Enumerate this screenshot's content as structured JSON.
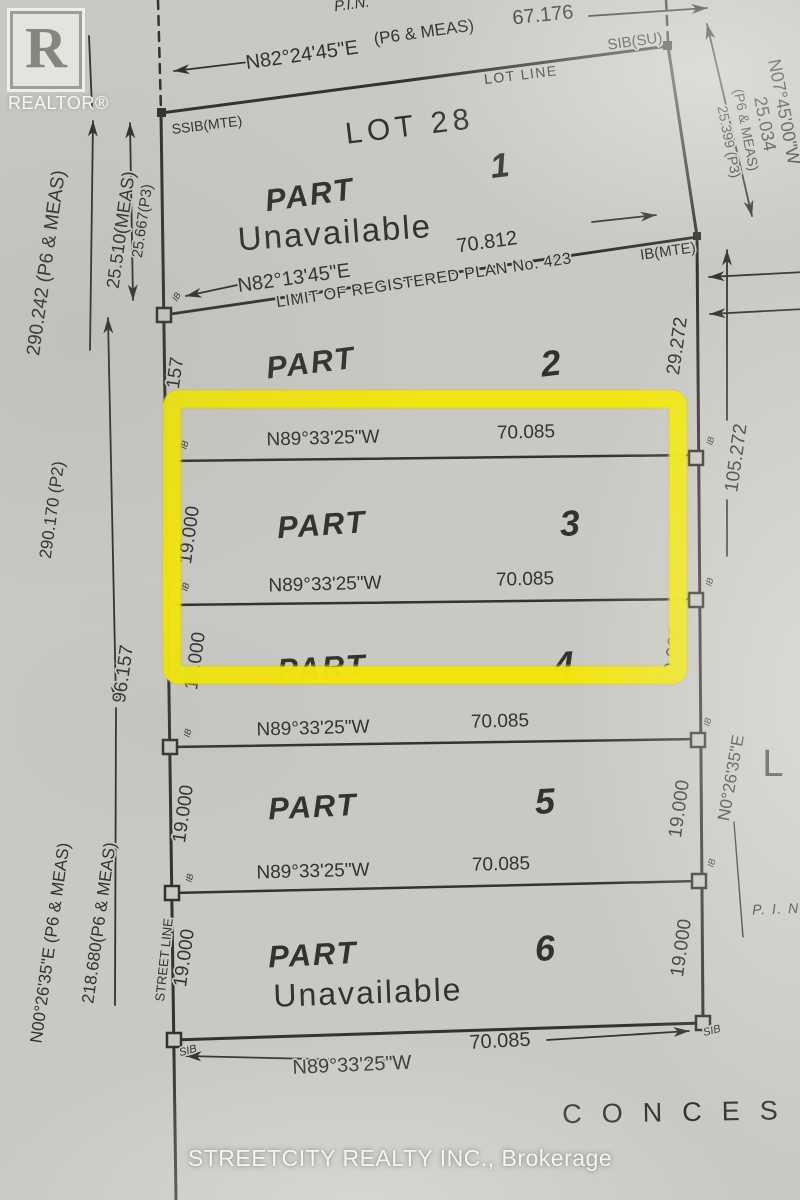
{
  "colors": {
    "paper": "#c9c8c3",
    "ink": "#34322d",
    "muted_ink": "#4e4c47",
    "highlight_yellow": "#f2e50d",
    "watermark_white": "rgba(253,253,251,0.9)"
  },
  "branding": {
    "realtor_r": "R",
    "realtor_wordmark": "REALTOR®",
    "brokerage_watermark": "STREETCITY REALTY INC., Brokerage"
  },
  "plan": {
    "labels": [
      {
        "name": "pin-top",
        "text": "P.I.N.",
        "x": 352,
        "y": 5,
        "rot": -8,
        "size": 15,
        "italic": true
      },
      {
        "name": "bearing-top",
        "text": "N82°24'45\"E",
        "x": 302,
        "y": 56,
        "rot": -8,
        "size": 20
      },
      {
        "name": "meas-top",
        "text": "(P6 & MEAS)",
        "x": 424,
        "y": 33,
        "rot": -8,
        "size": 17
      },
      {
        "name": "dist-top",
        "text": "67.176",
        "x": 543,
        "y": 16,
        "rot": -6,
        "size": 20
      },
      {
        "name": "sib-su",
        "text": "SIB(SU)",
        "x": 635,
        "y": 42,
        "rot": -8,
        "size": 15
      },
      {
        "name": "lot-line",
        "text": "LOT LINE",
        "x": 521,
        "y": 76,
        "rot": -7,
        "size": 14,
        "spacing": 1.5
      },
      {
        "name": "ssib-mte",
        "text": "SSIB(MTE)",
        "x": 207,
        "y": 126,
        "rot": -7,
        "size": 14
      },
      {
        "name": "lot-28",
        "text": "LOT 28",
        "x": 410,
        "y": 128,
        "rot": -7,
        "size": 30,
        "spacing": 5
      },
      {
        "name": "part1-num",
        "text": "1",
        "x": 500,
        "y": 168,
        "rot": -7,
        "size": 34,
        "italic": true,
        "bold": true
      },
      {
        "name": "part1-label",
        "text": "PART",
        "x": 310,
        "y": 197,
        "rot": -8,
        "size": 31,
        "italic": true,
        "bold": true,
        "spacing": 2
      },
      {
        "name": "part1-unavailable",
        "text": "Unavailable",
        "x": 335,
        "y": 235,
        "rot": -4,
        "size": 33,
        "spacing": 2,
        "color": "#4e4c47"
      },
      {
        "name": "dist-70-812",
        "text": "70.812",
        "x": 487,
        "y": 243,
        "rot": -8,
        "size": 20
      },
      {
        "name": "ib-mte",
        "text": "IB(MTE)",
        "x": 668,
        "y": 252,
        "rot": -8,
        "size": 15
      },
      {
        "name": "bearing-n82-13-45",
        "text": "N82°13'45\"E",
        "x": 294,
        "y": 279,
        "rot": -8,
        "size": 20
      },
      {
        "name": "limit-plan-423",
        "text": "LIMIT OF REGISTERED PLAN No. 423",
        "x": 424,
        "y": 281,
        "rot": -8.5,
        "size": 16,
        "spacing": 0.5
      },
      {
        "name": "ib-tick-limit",
        "text": "IB",
        "x": 177,
        "y": 297,
        "rot": -60,
        "size": 9,
        "italic": true
      },
      {
        "name": "part2-label",
        "text": "PART",
        "x": 311,
        "y": 365,
        "rot": -7,
        "size": 31,
        "italic": true,
        "bold": true,
        "spacing": 2
      },
      {
        "name": "part2-num",
        "text": "2",
        "x": 551,
        "y": 366,
        "rot": -7,
        "size": 36,
        "italic": true,
        "bold": true
      },
      {
        "name": "dim-157",
        "text": "157",
        "x": 176,
        "y": 373,
        "rot": -82,
        "size": 19
      },
      {
        "name": "dim-29-272",
        "text": "29.272",
        "x": 678,
        "y": 346,
        "rot": -82,
        "size": 19
      },
      {
        "name": "dim-105-272",
        "text": "105.272",
        "x": 737,
        "y": 458,
        "rot": -82,
        "size": 19
      },
      {
        "name": "bearing-part3-top",
        "text": "N89°33'25\"W",
        "x": 323,
        "y": 439,
        "rot": -1.5,
        "size": 19
      },
      {
        "name": "dist-part3-top",
        "text": "70.085",
        "x": 526,
        "y": 433,
        "rot": -1.5,
        "size": 19
      },
      {
        "name": "part3-label",
        "text": "PART",
        "x": 322,
        "y": 527,
        "rot": -4,
        "size": 31,
        "italic": true,
        "bold": true,
        "spacing": 2
      },
      {
        "name": "part3-num",
        "text": "3",
        "x": 570,
        "y": 526,
        "rot": -4,
        "size": 36,
        "italic": true,
        "bold": true
      },
      {
        "name": "dim-19-part3-left",
        "text": "19.000",
        "x": 190,
        "y": 535,
        "rot": -82,
        "size": 19
      },
      {
        "name": "bearing-part3-bot",
        "text": "N89°33'25\"W",
        "x": 325,
        "y": 585,
        "rot": -1.5,
        "size": 19
      },
      {
        "name": "dist-part3-bot",
        "text": "70.085",
        "x": 525,
        "y": 580,
        "rot": -1.5,
        "size": 19
      },
      {
        "name": "part4-label",
        "text": "PART",
        "x": 322,
        "y": 670,
        "rot": -3,
        "size": 31,
        "italic": true,
        "bold": true,
        "spacing": 2
      },
      {
        "name": "part4-num",
        "text": "4",
        "x": 564,
        "y": 667,
        "rot": -3,
        "size": 36,
        "italic": true,
        "bold": true
      },
      {
        "name": "dim-19-part4-left",
        "text": "19.000",
        "x": 196,
        "y": 661,
        "rot": -82,
        "size": 19
      },
      {
        "name": "dim-19-part4-right",
        "text": "19.000",
        "x": 674,
        "y": 655,
        "rot": -82,
        "size": 19
      },
      {
        "name": "bearing-part4-5",
        "text": "N89°33'25\"W",
        "x": 313,
        "y": 729,
        "rot": -1.5,
        "size": 19
      },
      {
        "name": "dist-part4-5",
        "text": "70.085",
        "x": 500,
        "y": 722,
        "rot": -1.5,
        "size": 19
      },
      {
        "name": "part5-label",
        "text": "PART",
        "x": 313,
        "y": 809,
        "rot": -3,
        "size": 31,
        "italic": true,
        "bold": true,
        "spacing": 2
      },
      {
        "name": "part5-num",
        "text": "5",
        "x": 545,
        "y": 804,
        "rot": -3,
        "size": 36,
        "italic": true,
        "bold": true
      },
      {
        "name": "dim-19-part5-left",
        "text": "19.000",
        "x": 184,
        "y": 814,
        "rot": -82,
        "size": 19
      },
      {
        "name": "dim-19-part5-right",
        "text": "19.000",
        "x": 680,
        "y": 809,
        "rot": -82,
        "size": 19
      },
      {
        "name": "bearing-part5-6",
        "text": "N89°33'25\"W",
        "x": 313,
        "y": 872,
        "rot": -1.5,
        "size": 19
      },
      {
        "name": "dist-part5-6",
        "text": "70.085",
        "x": 501,
        "y": 865,
        "rot": -1.5,
        "size": 19
      },
      {
        "name": "part6-label",
        "text": "PART",
        "x": 313,
        "y": 957,
        "rot": -3,
        "size": 31,
        "italic": true,
        "bold": true,
        "spacing": 2
      },
      {
        "name": "part6-num",
        "text": "6",
        "x": 545,
        "y": 951,
        "rot": -3,
        "size": 36,
        "italic": true,
        "bold": true
      },
      {
        "name": "part6-unavailable",
        "text": "Unavailable",
        "x": 368,
        "y": 995,
        "rot": -2,
        "size": 32,
        "spacing": 2,
        "color": "#4e4c47"
      },
      {
        "name": "dim-19-part6-left",
        "text": "19.000",
        "x": 185,
        "y": 958,
        "rot": -82,
        "size": 19
      },
      {
        "name": "dim-19-part6-right",
        "text": "19.000",
        "x": 682,
        "y": 948,
        "rot": -82,
        "size": 19
      },
      {
        "name": "street-line",
        "text": "STREET LINE",
        "x": 165,
        "y": 960,
        "rot": -84,
        "size": 13
      },
      {
        "name": "bearing-bottom",
        "text": "N89°33'25\"W",
        "x": 352,
        "y": 1066,
        "rot": -2.5,
        "size": 20
      },
      {
        "name": "dist-bottom",
        "text": "70.085",
        "x": 500,
        "y": 1042,
        "rot": -3,
        "size": 20
      },
      {
        "name": "sib-bottom-left",
        "text": "SIB",
        "x": 188,
        "y": 1051,
        "rot": -15,
        "size": 11,
        "italic": true
      },
      {
        "name": "sib-bottom-right",
        "text": "SIB",
        "x": 712,
        "y": 1031,
        "rot": -15,
        "size": 11,
        "italic": true
      },
      {
        "name": "dim-290-242",
        "text": "290.242 (P6 & MEAS)",
        "x": 47,
        "y": 263,
        "rot": -82,
        "size": 19
      },
      {
        "name": "dim-25-510",
        "text": "25.510(MEAS)",
        "x": 122,
        "y": 230,
        "rot": -82,
        "size": 18
      },
      {
        "name": "dim-25-667",
        "text": "25.667(P3)",
        "x": 143,
        "y": 221,
        "rot": -82,
        "size": 15
      },
      {
        "name": "dim-290-170",
        "text": "290.170 (P2)",
        "x": 53,
        "y": 510,
        "rot": -82,
        "size": 17
      },
      {
        "name": "dim-96-157",
        "text": "96.157",
        "x": 124,
        "y": 674,
        "rot": -82,
        "size": 19
      },
      {
        "name": "dim-218-680",
        "text": "218.680(P6 & MEAS)",
        "x": 100,
        "y": 923,
        "rot": -82,
        "size": 17
      },
      {
        "name": "bearing-n00-26-35-left",
        "text": "N00°26'35\"E (P6 & MEAS)",
        "x": 51,
        "y": 943,
        "rot": -82,
        "size": 17
      },
      {
        "name": "bearing-n07-45-00",
        "text": "N07°45'00\"W",
        "x": 783,
        "y": 112,
        "rot": 79,
        "size": 18
      },
      {
        "name": "dist-25-034",
        "text": "25.034",
        "x": 764,
        "y": 124,
        "rot": 79,
        "size": 18
      },
      {
        "name": "meas-right",
        "text": "(P6 & MEAS)",
        "x": 745,
        "y": 130,
        "rot": 79,
        "size": 14
      },
      {
        "name": "dist-25-399",
        "text": "25.399 (P3)",
        "x": 728,
        "y": 142,
        "rot": 79,
        "size": 14
      },
      {
        "name": "bearing-n0-26-35-right",
        "text": "N0°26'35\"E",
        "x": 732,
        "y": 778,
        "rot": -80,
        "size": 17
      },
      {
        "name": "letter-l",
        "text": "L",
        "x": 773,
        "y": 766,
        "rot": 0,
        "size": 38
      },
      {
        "name": "pin-right",
        "text": "P. I. N",
        "x": 776,
        "y": 910,
        "rot": -2,
        "size": 14,
        "italic": true,
        "spacing": 1.5
      },
      {
        "name": "concession-text",
        "text": "CONCES",
        "x": 680,
        "y": 1114,
        "rot": -1,
        "size": 27,
        "spacing": 20
      },
      {
        "name": "ib-tick-p3top-left",
        "text": "IB",
        "x": 185,
        "y": 445,
        "rot": -75,
        "size": 9,
        "italic": true
      },
      {
        "name": "ib-tick-p3bot-left",
        "text": "IB",
        "x": 186,
        "y": 587,
        "rot": -75,
        "size": 9,
        "italic": true
      },
      {
        "name": "ib-tick-p45-left",
        "text": "IB",
        "x": 188,
        "y": 733,
        "rot": -75,
        "size": 9,
        "italic": true
      },
      {
        "name": "ib-tick-p56-left",
        "text": "IB",
        "x": 190,
        "y": 878,
        "rot": -75,
        "size": 9,
        "italic": true
      },
      {
        "name": "ib-tick-p3top-right",
        "text": "IB",
        "x": 711,
        "y": 441,
        "rot": -75,
        "size": 9,
        "italic": true
      },
      {
        "name": "ib-tick-p3bot-right",
        "text": "IB",
        "x": 710,
        "y": 582,
        "rot": -75,
        "size": 9,
        "italic": true
      },
      {
        "name": "ib-tick-p45-right",
        "text": "IB",
        "x": 708,
        "y": 722,
        "rot": -75,
        "size": 9,
        "italic": true
      },
      {
        "name": "ib-tick-p56-right",
        "text": "IB",
        "x": 712,
        "y": 863,
        "rot": -75,
        "size": 9,
        "italic": true
      }
    ]
  }
}
